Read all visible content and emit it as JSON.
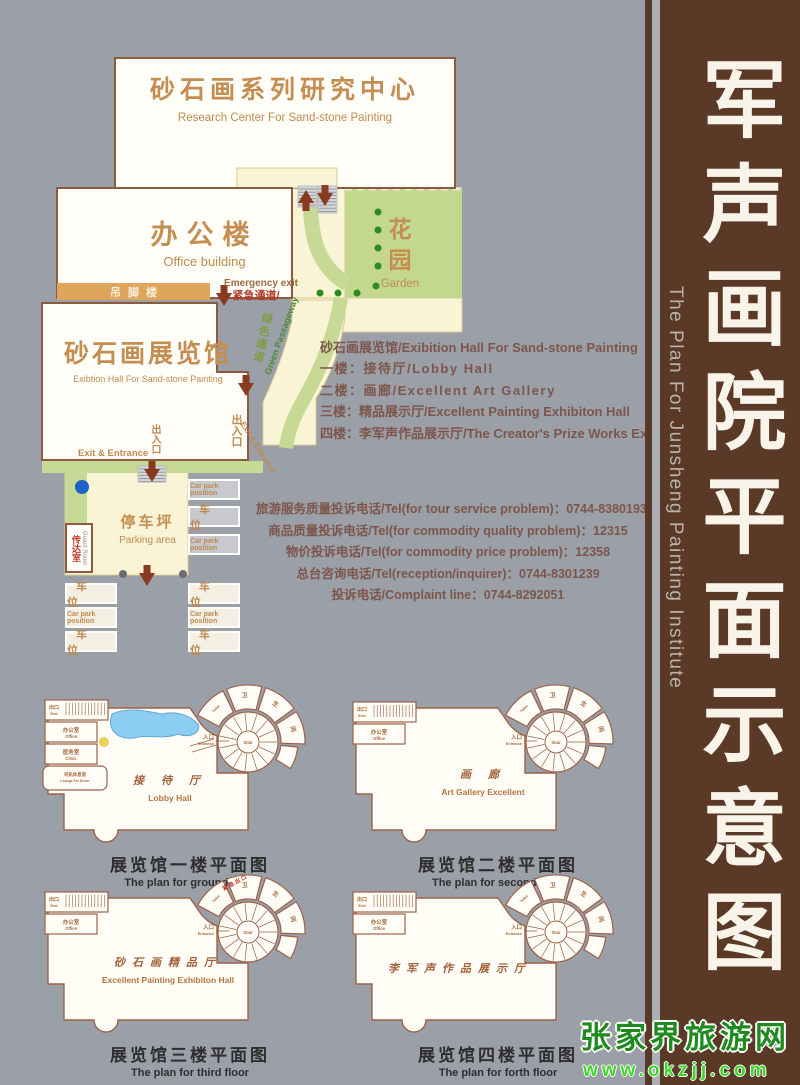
{
  "sidebar": {
    "title_cn": "军声画院平面示意图",
    "title_en": "The Plan For Junsheng Painting Institute"
  },
  "watermark": {
    "site_name": "张家界旅游网",
    "site_url": "www.okzjj.com"
  },
  "site_plan": {
    "research_center": {
      "cn": "砂石画系列研究中心",
      "en": "Research Center For Sand-stone Painting"
    },
    "office": {
      "cn": "办公楼",
      "en": "Office building"
    },
    "garden": {
      "cn_line1": "花",
      "cn_line2": "园",
      "en": "Garden"
    },
    "stilt_house": {
      "cn": "吊脚楼"
    },
    "emergency": {
      "en": "Emergency exit",
      "cn": "紧急通道/"
    },
    "exhibition_hall": {
      "cn": "砂石画展览馆",
      "en": "Exibtion Hall For Sand-stone Painting"
    },
    "green_passage": {
      "cn": "绿色通道",
      "en": "Green Passageway"
    },
    "exit_entrance_side": {
      "cn": "出入口",
      "en": "Exit & Entrance"
    },
    "exit_entrance_main": {
      "cn": "出入口",
      "en": "Exit & Entrance"
    },
    "parking": {
      "cn": "停车坪",
      "en": "Parking area"
    },
    "guard_room": {
      "cn": "传达室",
      "en": "Guard Room"
    },
    "car_park": {
      "cn": "车 位",
      "en": "Car park position"
    }
  },
  "floors_info": {
    "lines": [
      "砂石画展览馆/Exibition Hall For Sand-stone Painting",
      "一楼：接待厅/Lobby Hall",
      "二楼：画廊/Excellent Art Gallery",
      "三楼：精品展示厅/Excellent Painting Exhibiton Hall",
      "四楼：李军声作品展示厅/The Creator's Prize Works Exibition"
    ]
  },
  "phones": {
    "lines": [
      "旅游服务质量投诉电话/Tel(for tour service problem)：0744-8380193",
      "商品质量投诉电话/Tel(for commodity quality problem)：12315",
      "物价投诉电话/Tel(for commodity price problem)：12358",
      "总台咨询电话/Tel(reception/inquirer)：0744-8301239",
      "投诉电话/Complaint line：0744-8292051"
    ]
  },
  "stair_labels": {
    "toilet_en": "Toilet",
    "toilet_cn": "卫生间",
    "entrance_cn": "入口",
    "entrance_en": "Entrance",
    "stair_en": "Stair"
  },
  "floor_plans": [
    {
      "hall_cn": "接 待 厅",
      "hall_en": "Lobby Hall",
      "caption_cn": "展览馆一楼平面图",
      "caption_en": "The plan for ground floor",
      "rooms": [
        {
          "cn": "出口",
          "en": "Exit"
        },
        {
          "cn": "办公室",
          "en": "Office"
        },
        {
          "cn": "医务室",
          "en": "Clinic"
        },
        {
          "cn": "司机休息室",
          "en": "Lounge For Driver"
        }
      ]
    },
    {
      "hall_cn": "画  廊",
      "hall_en": "Art Gallery Excellent",
      "caption_cn": "展览馆二楼平面图",
      "caption_en": "The plan for second floor",
      "rooms": [
        {
          "cn": "出口",
          "en": "Exit"
        },
        {
          "cn": "办公室",
          "en": "Office"
        }
      ]
    },
    {
      "hall_cn": "砂石画精品厅",
      "hall_en": "Excellent Painting Exhibiton Hall",
      "caption_cn": "展览馆三楼平面图",
      "caption_en": "The plan for third floor",
      "emergency_cn": "紧急出口",
      "rooms": [
        {
          "cn": "出口",
          "en": "Exit"
        },
        {
          "cn": "办公室",
          "en": "Office"
        }
      ]
    },
    {
      "hall_cn": "李军声作品展示厅",
      "hall_en": "",
      "caption_cn": "展览馆四楼平面图",
      "caption_en": "The plan for forth floor",
      "rooms": [
        {
          "cn": "出口",
          "en": "Exit"
        },
        {
          "cn": "办公室",
          "en": "Office"
        }
      ]
    }
  ],
  "colors": {
    "background": "#9b9fa7",
    "sidebar_brown": "#5a3927",
    "cream": "#f9f4d6",
    "green": "#c6da96",
    "building_border": "#8e5a3d",
    "label_tan": "#c48e52",
    "arrow_brown": "#8a3a20",
    "watermark_green": "#1f8b1f"
  }
}
